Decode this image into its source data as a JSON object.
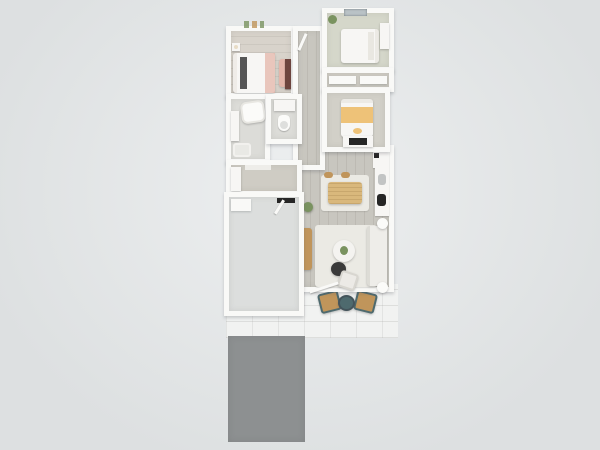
{
  "scene": {
    "type": "3d-floor-plan-top-down-render",
    "description": "Aerial 3D rendering of a single-story home floor plan with three bedrooms, two bathrooms, walk-in closet, open kitchen/dining/living great room, garage, rear patio with chairs, and gray driveway pad",
    "visible_text": "none"
  },
  "colors": {
    "bg_center": "#edeff0",
    "bg_edge": "#dde0e1",
    "wall": "#f9f9f7",
    "floor_master": "#d8d3cb",
    "floor_bed2": "#d5d7ca",
    "floor_bed3": "#d2d0c8",
    "floor_plank": "#c8c6bf",
    "floor_tile": "#dcdcd8",
    "floor_closet": "#cfccc4",
    "floor_garage": "#dcdedd",
    "pad": "#f1f2f1",
    "driveway": "#8d9091",
    "white_obj": "#f7f6f4",
    "sofa": "#eeede9",
    "rug": "#ebeae4",
    "wood": "#c0955b",
    "wood_light": "#d9b87c",
    "dark": "#3a3a3a",
    "appliance_dark": "#262626",
    "teal": "#4e6a6e",
    "pink": "#e4b6aa",
    "yellow": "#eec278",
    "green": "#7a9360",
    "maroon": "#6e453e",
    "window_glass": "#b9c2c6",
    "sink_gray": "#c2c4c4"
  },
  "objects": [
    "master-bedroom",
    "master-bed",
    "master-bench",
    "master-nightstand",
    "tall-cabinet",
    "entry-hall",
    "front-door",
    "bedroom-2",
    "bed-2",
    "dresser-2",
    "plant-bed2",
    "window-bed2",
    "closet-bed2",
    "bedroom-3",
    "bed-3",
    "dresser-3",
    "tv-3",
    "master-bathroom",
    "bathtub",
    "vanity-master",
    "hall-bathroom",
    "toilet",
    "vanity-hall",
    "walk-in-closet",
    "wardrobe",
    "great-room",
    "kitchen-fridge",
    "kitchen-counter",
    "kitchen-sink",
    "dining-rug",
    "dining-table",
    "living-rug",
    "sofa",
    "coffee-table",
    "coffee-table-plant",
    "pouf",
    "accent-chair",
    "tv-console",
    "tv",
    "floor-lamp",
    "plant",
    "garage",
    "garage-door-threshold",
    "garage-shelf",
    "patio-pad",
    "patio-chair-left",
    "patio-chair-right",
    "patio-table",
    "driveway"
  ]
}
